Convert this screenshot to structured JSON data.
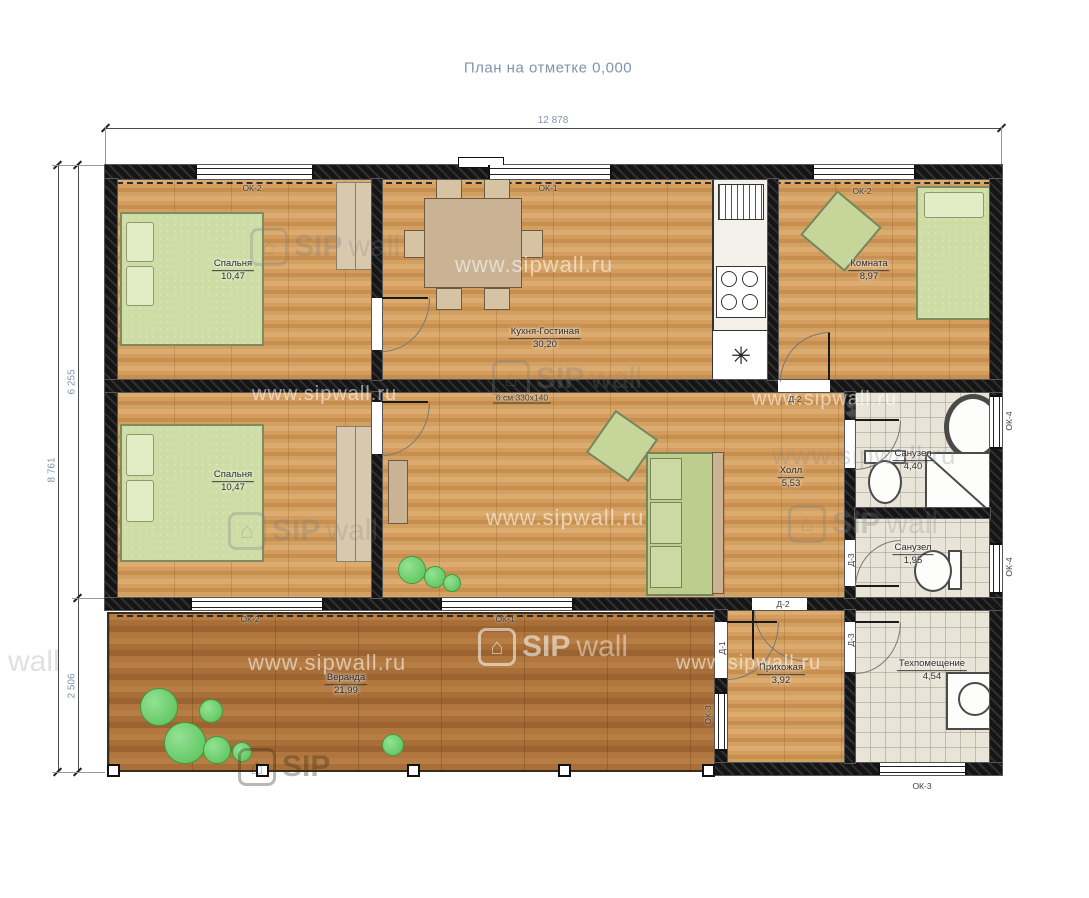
{
  "title": "План на отметке 0,000",
  "dimensions": {
    "width_top": "12 878",
    "height_total": "8 761",
    "height_main": "6 255",
    "height_veranda": "2 506"
  },
  "beam_note": "6 см 330х140",
  "rooms": [
    {
      "name": "Спальня",
      "area": "10,47"
    },
    {
      "name": "Кухня-Гостиная",
      "area": "30,20"
    },
    {
      "name": "Комната",
      "area": "8,97"
    },
    {
      "name": "Спальня",
      "area": "10,47"
    },
    {
      "name": "Холл",
      "area": "5,53"
    },
    {
      "name": "Санузел",
      "area": "4,40"
    },
    {
      "name": "Санузел",
      "area": "1,95"
    },
    {
      "name": "Прихожая",
      "area": "3,92"
    },
    {
      "name": "Техпомещение",
      "area": "4,54"
    },
    {
      "name": "Веранда",
      "area": "21,99"
    }
  ],
  "openings": {
    "ok1": "ОК-1",
    "ok2": "ОК-2",
    "ok3": "ОК-3",
    "ok4": "ОК-4",
    "d1": "Д-1",
    "d2": "Д-2",
    "d3": "Д-3"
  },
  "watermark": {
    "sip": "SIP",
    "wall": "wall",
    "url": "www.sipwall.ru"
  },
  "colors": {
    "dimension_text": "#8494ad",
    "wood_floor": "#d49d5d",
    "veranda_deck": "#a86f38",
    "bed_green": "#cedda6",
    "wall_black": "#1a1a1a"
  }
}
